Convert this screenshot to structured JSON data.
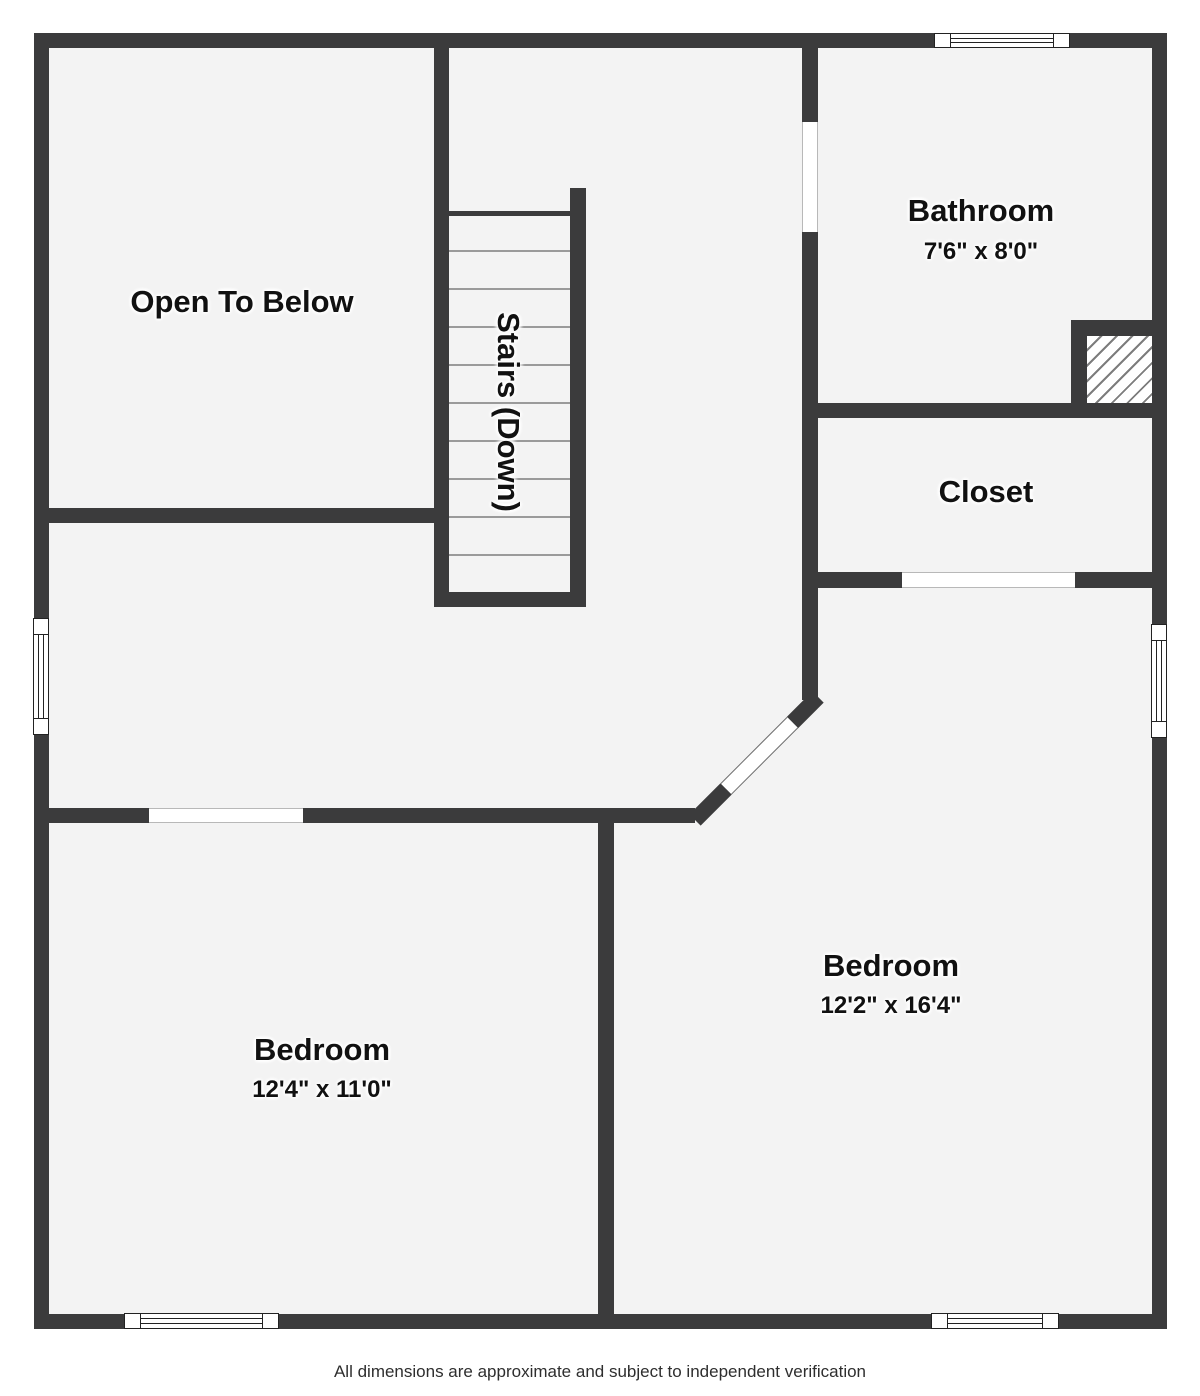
{
  "plan": {
    "rooms": [
      {
        "id": "open-to-below",
        "label": "Open To Below",
        "dims": ""
      },
      {
        "id": "stairs",
        "label": "Stairs (Down)",
        "dims": ""
      },
      {
        "id": "bathroom",
        "label": "Bathroom",
        "dims": "7'6\" x 8'0\""
      },
      {
        "id": "closet",
        "label": "Closet",
        "dims": ""
      },
      {
        "id": "bedroom-left",
        "label": "Bedroom",
        "dims": "12'4\" x 11'0\""
      },
      {
        "id": "bedroom-right",
        "label": "Bedroom",
        "dims": "12'2\" x 16'4\""
      }
    ],
    "footer": "All dimensions are approximate and subject to independent verification",
    "colors": {
      "wall": "#3b3b3c",
      "floor": "#f3f3f3",
      "background": "#ffffff",
      "tread_line": "#9a9a9a",
      "hatch_line": "#7d7d7d"
    }
  }
}
